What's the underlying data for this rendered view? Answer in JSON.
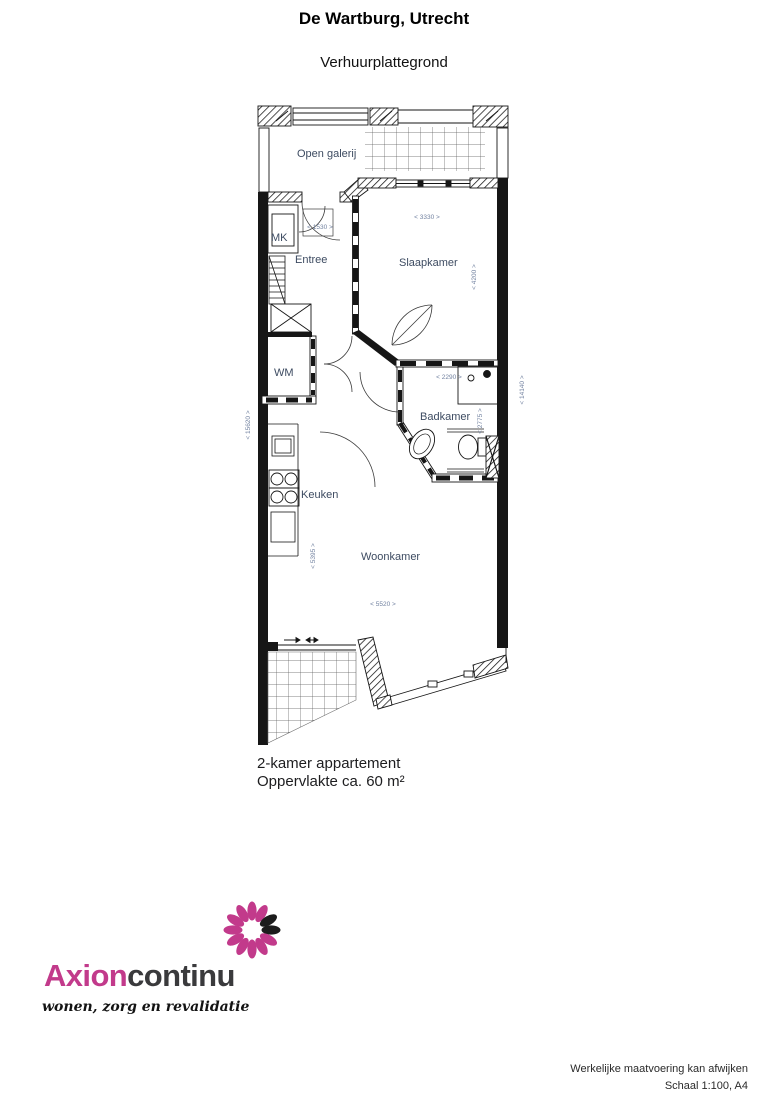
{
  "page": {
    "title": "De Wartburg, Utrecht",
    "subtitle": "Verhuurplattegrond"
  },
  "floorplan": {
    "rooms": {
      "open_galerij": "Open galerij",
      "mk": "MK",
      "entree": "Entree",
      "slaapkamer": "Slaapkamer",
      "wm": "WM",
      "badkamer": "Badkamer",
      "keuken": "Keuken",
      "woonkamer": "Woonkamer"
    },
    "dimensions": {
      "d3330": "< 3330 >",
      "d4200": "< 4200 >",
      "d1530": "< 1530 >",
      "d2290": "< 2290 >",
      "d2775": "< 2775 >",
      "d5395": "< 5395 >",
      "d5520": "< 5520 >",
      "d14140": "< 14140 >",
      "d15620": "< 15620 >"
    }
  },
  "caption": {
    "line1": "2-kamer appartement",
    "line2": "Oppervlakte ca. 60 m²"
  },
  "logo": {
    "name_primary": "Axion",
    "name_secondary": "continu",
    "tagline": "wonen, zorg en revalidatie",
    "accent_color": "#c23a8b",
    "dark_color": "#3a3a3c"
  },
  "footer": {
    "note": "Werkelijke maatvoering kan afwijken",
    "scale": "Schaal 1:100, A4"
  }
}
